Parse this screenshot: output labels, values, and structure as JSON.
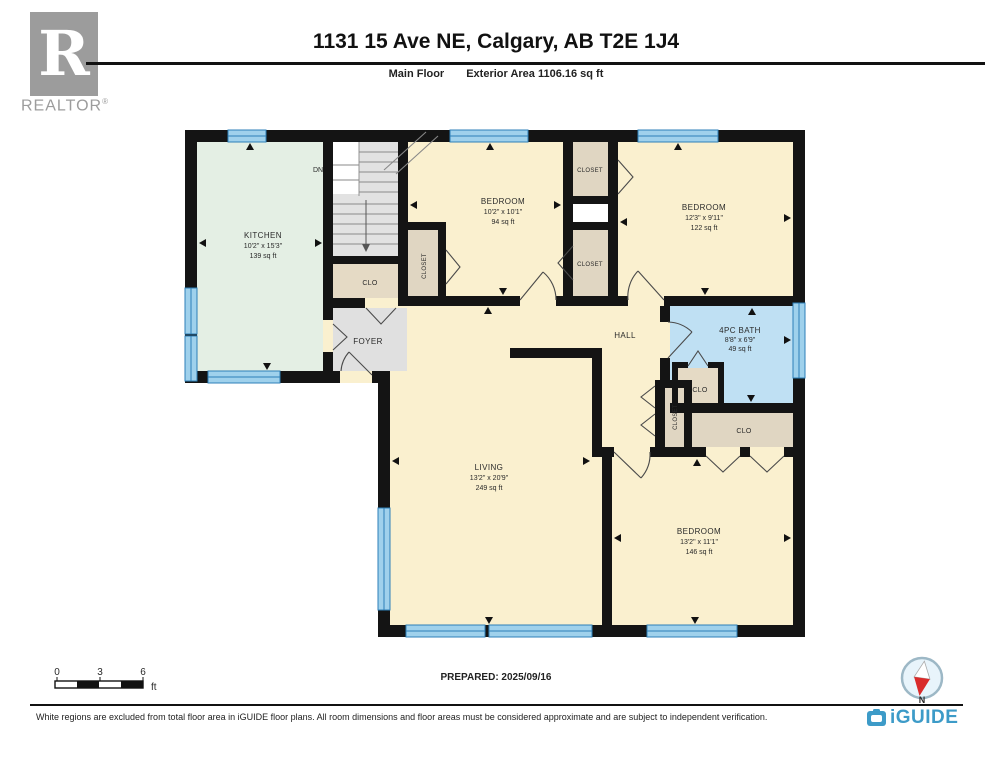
{
  "header": {
    "title": "1131 15 Ave NE, Calgary, AB T2E 1J4",
    "floor_label": "Main Floor",
    "area_label": "Exterior Area 1106.16 sq ft"
  },
  "branding": {
    "realtor_r": "R",
    "realtor_text": "REALTOR",
    "realtor_reg": "®",
    "iguide_text": "iGUIDE"
  },
  "rooms": {
    "kitchen": {
      "name": "KITCHEN",
      "dims": "10'2\" x 15'3\"",
      "area": "139 sq ft"
    },
    "bedroom1": {
      "name": "BEDROOM",
      "dims": "10'2\" x 10'1\"",
      "area": "94 sq ft"
    },
    "bedroom2": {
      "name": "BEDROOM",
      "dims": "12'3\" x 9'11\"",
      "area": "122 sq ft"
    },
    "bath": {
      "name": "4PC BATH",
      "dims": "8'8\" x 6'9\"",
      "area": "49 sq ft"
    },
    "living": {
      "name": "LIVING",
      "dims": "13'2\" x 20'9\"",
      "area": "249 sq ft"
    },
    "bedroom3": {
      "name": "BEDROOM",
      "dims": "13'2\" x 11'1\"",
      "area": "146 sq ft"
    },
    "hall": {
      "name": "HALL"
    },
    "foyer": {
      "name": "FOYER"
    },
    "stairs": {
      "label": "DN"
    }
  },
  "labels": {
    "clo": "CLO",
    "closet": "CLOSET"
  },
  "scale_bar": {
    "tick0": "0",
    "tick1": "3",
    "tick2": "6",
    "unit": "ft"
  },
  "compass": {
    "label": "N"
  },
  "footer": {
    "prepared": "PREPARED: 2025/09/16",
    "disclaimer": "White regions are excluded from total floor area in iGUIDE floor plans. All room dimensions and floor areas must be considered approximate and are subject to independent verification."
  }
}
